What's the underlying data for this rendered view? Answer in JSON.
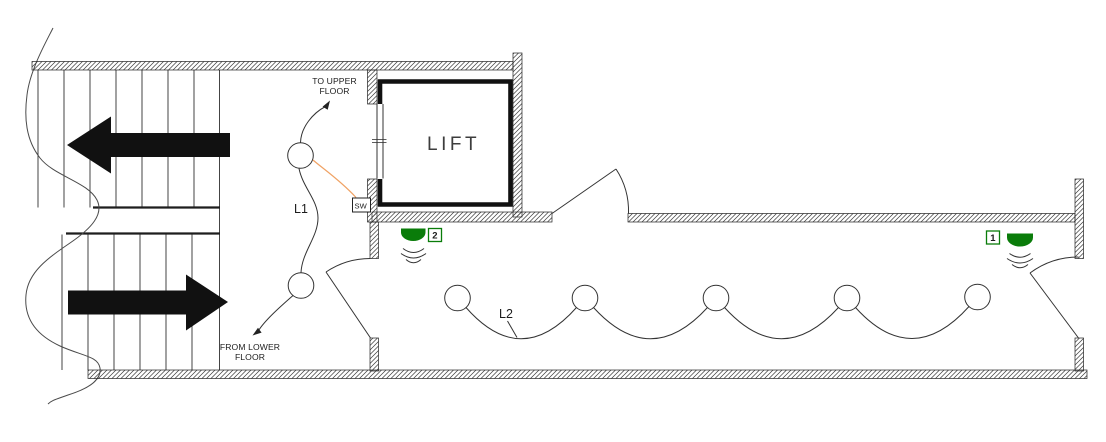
{
  "drawing": {
    "type": "floor-plan-lighting-layout",
    "room_labels": {
      "lift": "LIFT"
    },
    "annotations": {
      "to_upper_line1": "TO UPPER",
      "to_upper_line2": "FLOOR",
      "from_lower_line1": "FROM LOWER",
      "from_lower_line2": "FLOOR"
    },
    "circuits": {
      "l1": "L1",
      "l2": "L2"
    },
    "switch_label": "SW",
    "sensors": {
      "s1": "1",
      "s2": "2"
    },
    "lights": {
      "l1_count": 2,
      "l2_count": 5
    },
    "colors": {
      "sensor_green": "#0a7c0a",
      "wire_orange": "#f0a264",
      "line_dark": "#2f2f2f"
    }
  }
}
